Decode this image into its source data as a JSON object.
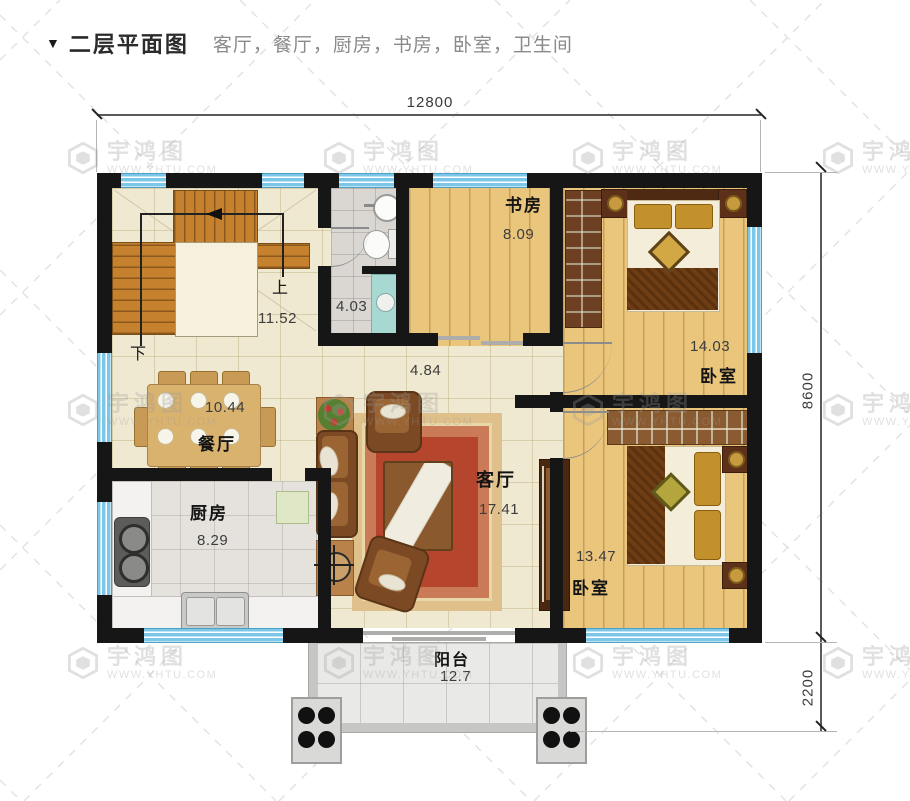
{
  "header": {
    "marker": "▼",
    "title": "二层平面图",
    "subtitle": "客厅，餐厅，厨房，书房，卧室，卫生间"
  },
  "dimensions": {
    "top_width": "12800",
    "right_height": "8600",
    "balcony_depth": "2200"
  },
  "rooms": {
    "stairwell": {
      "area": "11.52",
      "up": "上",
      "down": "下"
    },
    "bathroom": {
      "area": "4.03"
    },
    "study": {
      "name": "书房",
      "area": "8.09"
    },
    "hallway": {
      "area": "4.84"
    },
    "bedroom_top": {
      "name": "卧室",
      "area": "14.03"
    },
    "dining": {
      "name": "餐厅",
      "area": "10.44"
    },
    "kitchen": {
      "name": "厨房",
      "area": "8.29"
    },
    "living": {
      "name": "客厅",
      "area": "17.41"
    },
    "bedroom_bottom": {
      "name": "卧室",
      "area": "13.47"
    },
    "balcony": {
      "name": "阳台",
      "area": "12.7"
    }
  },
  "watermark": {
    "brand": "宇鸿图",
    "url": "WWW.YHTU.COM"
  },
  "colors": {
    "wall": "#161616",
    "window_blue": "#7cc7e7",
    "floor_cream": "#f0e9d1",
    "wood": "#eac57c",
    "rug_red": "#ab3f2a",
    "stair_orange": "#c5812e"
  }
}
